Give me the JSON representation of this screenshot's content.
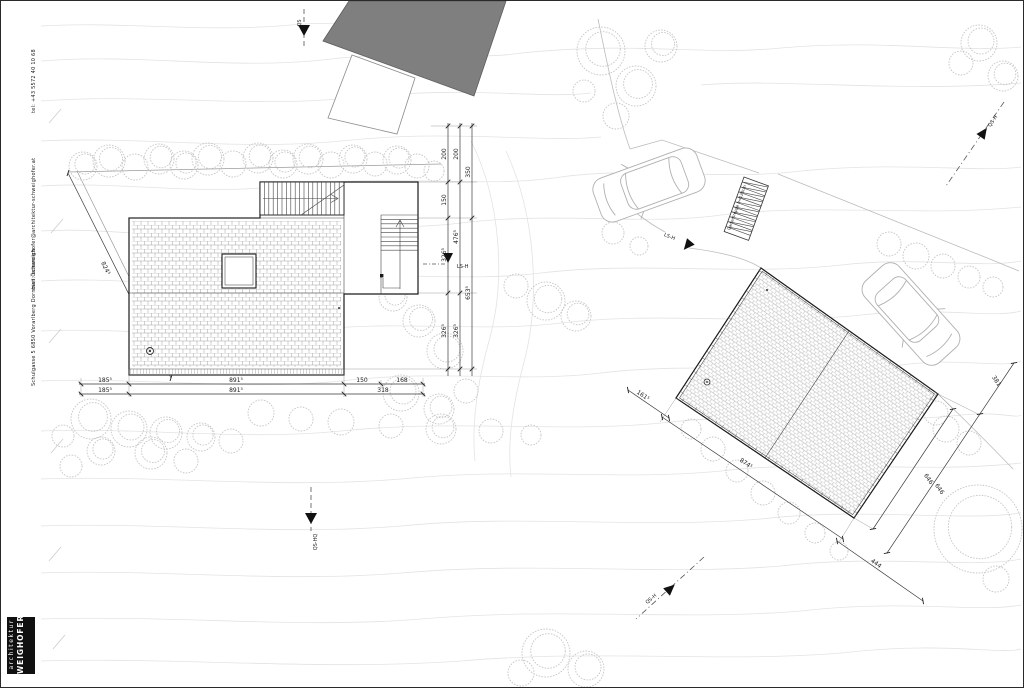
{
  "sidebar": {
    "tel": "tel: +43 5572 40 10 68",
    "mail": "mail: schweighofer@architektur-schweighofer.at",
    "address": "Schulgasse 5 6850 Vorarlberg Dornbirn Österreich",
    "logo": {
      "line1": "architektur",
      "line2": "WEIGHOFER"
    }
  },
  "colors": {
    "paper": "#ffffff",
    "ink": "#1a1a1a",
    "neighbor_roof_fill": "#7f7f7f",
    "contour": "#e3e3e3",
    "tree": "#c6c6c6",
    "vehicle": "#b0b0b0"
  },
  "plan": {
    "labels": [
      {
        "t": "185⁵",
        "x": 104,
        "y": 381,
        "r": 0
      },
      {
        "t": "891⁵",
        "x": 235,
        "y": 381,
        "r": 0
      },
      {
        "t": "150",
        "x": 361,
        "y": 381,
        "r": 0
      },
      {
        "t": "168",
        "x": 401,
        "y": 381,
        "r": 0
      },
      {
        "t": "185⁵",
        "x": 104,
        "y": 391,
        "r": 0
      },
      {
        "t": "891⁵",
        "x": 235,
        "y": 391,
        "r": 0
      },
      {
        "t": "318",
        "x": 382,
        "y": 391,
        "r": 0
      },
      {
        "t": "824⁵",
        "x": 103,
        "y": 268,
        "r": 64
      },
      {
        "t": "200",
        "x": 445,
        "y": 153,
        "r": -90
      },
      {
        "t": "150",
        "x": 445,
        "y": 199,
        "r": -90
      },
      {
        "t": "326⁵",
        "x": 445,
        "y": 254,
        "r": -90
      },
      {
        "t": "326⁵",
        "x": 445,
        "y": 330,
        "r": -90
      },
      {
        "t": "200",
        "x": 457,
        "y": 153,
        "r": -90
      },
      {
        "t": "476⁵",
        "x": 457,
        "y": 236,
        "r": -90
      },
      {
        "t": "326⁵",
        "x": 457,
        "y": 330,
        "r": -90
      },
      {
        "t": "350",
        "x": 469,
        "y": 171,
        "r": -90
      },
      {
        "t": "653⁵",
        "x": 469,
        "y": 292,
        "r": -90
      },
      {
        "t": "161⁵",
        "x": 641,
        "y": 396,
        "r": 34
      },
      {
        "t": "874⁵",
        "x": 744,
        "y": 464,
        "r": 34
      },
      {
        "t": "381",
        "x": 994,
        "y": 381,
        "r": 56
      },
      {
        "t": "646",
        "x": 926,
        "y": 479,
        "r": 56
      },
      {
        "t": "646",
        "x": 937,
        "y": 489,
        "r": 56
      },
      {
        "t": "444",
        "x": 874,
        "y": 564,
        "r": 35
      },
      {
        "t": "QS",
        "x": 300,
        "y": 22,
        "r": -90,
        "s": 5
      },
      {
        "t": "QS-HQ",
        "x": 316,
        "y": 541,
        "r": -90,
        "s": 5
      },
      {
        "t": "LS-H",
        "x": 456,
        "y": 267,
        "r": 0,
        "s": 5,
        "a": "start"
      },
      {
        "t": "LS-H",
        "x": 668,
        "y": 237,
        "r": 22,
        "s": 5
      },
      {
        "t": "QS-H",
        "x": 651,
        "y": 599,
        "r": -41,
        "s": 5
      },
      {
        "t": "QS-H",
        "x": 993,
        "y": 121,
        "r": -56,
        "s": 5
      },
      {
        "t": "Gartentreppe b=120cm",
        "x": 737,
        "y": 207,
        "r": -70,
        "s": 4
      }
    ]
  }
}
